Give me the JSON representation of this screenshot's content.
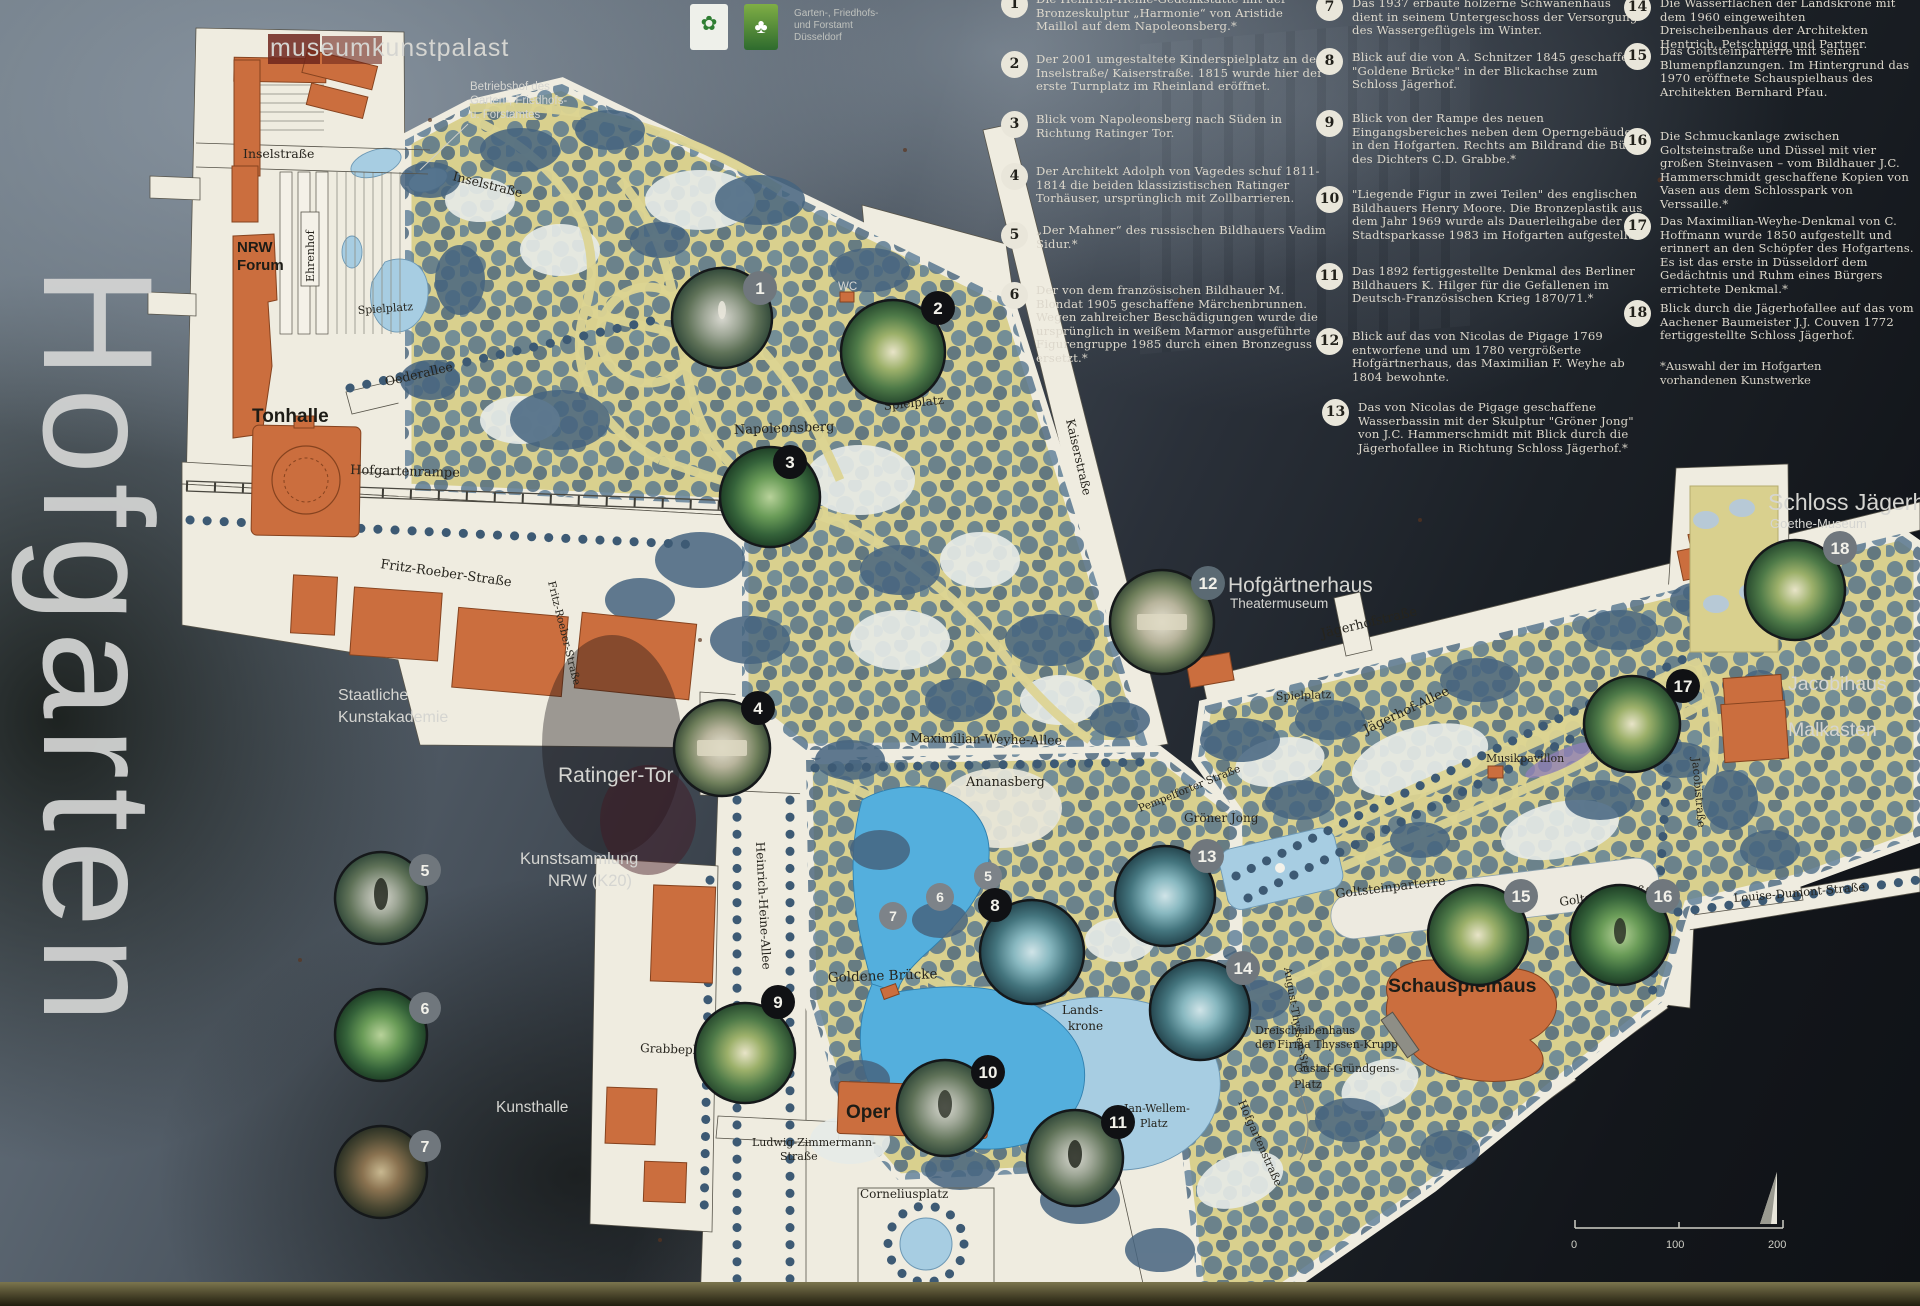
{
  "board": {
    "title": "Hofgarten"
  },
  "agency": {
    "l1": "Garten-, Friedhofs-",
    "l2": "und Forstamt",
    "l3": "Düsseldorf"
  },
  "legend": {
    "items": [
      {
        "n": "1",
        "text": "Die Heinrich-Heine-Gedenkstätte mit der Bronzeskulptur „Harmonie“ von Aristide Maillol auf dem Napoleonsberg.*"
      },
      {
        "n": "2",
        "text": "Der 2001 umgestaltete Kinderspielplatz an der Inselstraße/ Kaiserstraße. 1815 wurde hier der erste Turnplatz im Rheinland eröffnet."
      },
      {
        "n": "3",
        "text": "Blick vom Napoleonsberg nach Süden in Richtung Ratinger Tor."
      },
      {
        "n": "4",
        "text": "Der Architekt Adolph von Vagedes schuf 1811-1814 die beiden klassizistischen Ratinger Torhäuser, ursprünglich mit Zollbarrieren."
      },
      {
        "n": "5",
        "text": "„Der Mahner“ des russischen Bildhauers Vadim Sidur.*"
      },
      {
        "n": "6",
        "text": "Der von dem französischen Bildhauer M. Blondat 1905 geschaffene Märchenbrunnen. Wegen zahlreicher Beschädigungen wurde die ursprünglich in weißem Marmor ausgeführte Figurengruppe 1985 durch einen Bronzeguss ersetzt.*"
      },
      {
        "n": "7",
        "text": "Das 1937 erbaute hölzerne Schwanenhaus dient in seinem Untergeschoss der Versorgung des Wassergeflügels im Winter."
      },
      {
        "n": "8",
        "text": "Blick auf die von A. Schnitzer 1845 geschaffene \"Goldene Brücke\" in der Blickachse zum Schloss Jägerhof."
      },
      {
        "n": "9",
        "text": "Blick von der Rampe des neuen Eingangsbereiches neben dem Operngebäude in den Hofgarten. Rechts am Bildrand die Büste des Dichters C.D. Grabbe.*"
      },
      {
        "n": "10",
        "text": "\"Liegende Figur in zwei Teilen\" des englischen Bildhauers Henry Moore. Die Bronzeplastik aus dem Jahr 1969 wurde als Dauerleihgabe der Stadtsparkasse 1983 im Hofgarten aufgestellt.*"
      },
      {
        "n": "11",
        "text": "Das 1892 fertiggestellte Denkmal des Berliner Bildhauers K. Hilger für die Gefallenen im Deutsch-Französischen Krieg 1870/71.*"
      },
      {
        "n": "12",
        "text": "Blick auf das von Nicolas de Pigage 1769 entworfene und um 1780 vergrößerte Hofgärtnerhaus, das Maximilian F. Weyhe ab 1804 bewohnte."
      },
      {
        "n": "13",
        "text": "Das von Nicolas de Pigage geschaffene Wasserbassin mit der Skulptur \"Gröner Jong\" von J.C. Hammerschmidt mit Blick durch die Jägerhofallee in Richtung Schloss Jägerhof.*"
      },
      {
        "n": "14",
        "text": "Die Wasserflächen der Landskrone mit dem 1960 eingeweihten Dreischeibenhaus der Architekten Hentrich, Petschnigg und Partner."
      },
      {
        "n": "15",
        "text": "Das Goltsteinparterre mit seinen Blumenpflanzungen. Im Hintergrund das 1970 eröffnete Schauspielhaus des Architekten Bernhard Pfau."
      },
      {
        "n": "16",
        "text": "Die Schmuckanlage zwischen Goltsteinstraße und Düssel mit vier großen Steinvasen – vom Bildhauer J.C. Hammerschmidt geschaffene Kopien von Vasen aus dem Schlosspark von Verssaille.*"
      },
      {
        "n": "17",
        "text": "Das Maximilian-Weyhe-Denkmal von C. Hoffmann wurde 1850 aufgestellt und erinnert an den Schöpfer des Hofgartens. Es ist das erste in Düsseldorf dem Gedächtnis und Ruhm eines Bürgers errichtete Denkmal.*"
      },
      {
        "n": "18",
        "text": "Blick durch die Jägerhofallee auf das vom Aachener Baumeister J.J. Couven 1772 fertiggestellte Schloss Jägerhof."
      }
    ],
    "footnote": "*Auswahl der im Hofgarten vorhandenen Kunstwerke"
  },
  "map": {
    "labels": {
      "museumkunstpalast": "museumkunstpalast",
      "betriebshof_1": "Betriebshof des",
      "betriebshof_2": "Garten-, Friedhofs-",
      "betriebshof_3": "u. Forstamtes",
      "inselstrasse_w": "Inselstraße",
      "inselstrasse_e": "Inselstraße",
      "nrw_forum_1": "NRW",
      "nrw_forum_2": "Forum",
      "ehrenhof": "Ehrenhof",
      "spielplatz_nw": "Spielplatz",
      "spielplatz_n": "Spielplatz",
      "spielplatz_e": "Spielplatz",
      "oederallee": "Oederallee",
      "tonhalle": "Tonhalle",
      "hofgartenrampe": "Hofgartenrampe",
      "fritz_roeber_1": "Fritz-Roeber-Straße",
      "fritz_roeber_2": "Fritz-Roeber-Straße",
      "kunstakademie_1": "Staatliche",
      "kunstakademie_2": "Kunstakademie",
      "ratinger_tor": "Ratinger-Tor",
      "kunstsammlung_1": "Kunstsammlung",
      "kunstsammlung_2": "NRW (K20)",
      "grabbeplatz": "Grabbeplatz",
      "kunsthalle": "Kunsthalle",
      "oper": "Oper",
      "ludwig_zimmermann_1": "Ludwig-Zimmermann-",
      "ludwig_zimmermann_2": "Straße",
      "corneliusplatz": "Corneliusplatz",
      "heinrich_heine_allee": "Heinrich-Heine-Allee",
      "goldene_bruecke": "Goldene Brücke",
      "landskrone_1": "Lands-",
      "landskrone_2": "krone",
      "ananasberg": "Ananasberg",
      "napoleonsberg": "Napoleonsberg",
      "kaiserstrasse": "Kaiserstraße",
      "wc": "WC",
      "max_weyhe_allee": "Maximilian-Weyhe-Allee",
      "pempelforter": "Pempelforter Straße",
      "hofgaertnerhaus": "Hofgärtnerhaus",
      "theatermuseum": "Theatermuseum",
      "jaegerhofstrasse": "Jägerhofstraße",
      "jaegerhof_allee": "Jägerhof-Allee",
      "musikpavillon": "Musikpavillon",
      "groener_jong": "Gröner Jong",
      "goltsteinparterre": "Goltsteinparterre",
      "goltsteinstrasse": "Goltsteinstraße",
      "louise_dumont": "Louise-Dumont-Straße",
      "schauspielhaus": "Schauspielhaus",
      "dreischeibenhaus_1": "Dreischeibenhaus",
      "dreischeibenhaus_2": "der Firma Thyssen-Krupp",
      "gustaf_1": "Gustaf-Gründgens-",
      "gustaf_2": "Platz",
      "august_thyssen": "August-Thyssen-Str.",
      "hofgartenstrasse": "Hofgartenstraße",
      "jan_wellem_1": "Jan-Wellem-",
      "jan_wellem_2": "Platz",
      "schloss_jaegerhof": "Schloss Jägerhof",
      "goethe_museum": "Goethe-Museum",
      "jacobihaus": "Jacobihaus",
      "malkasten": "Malkasten",
      "jacobistrasse": "Jacobistraße"
    }
  },
  "scalebar": {
    "t0": "0",
    "t1": "100",
    "t2": "200"
  }
}
